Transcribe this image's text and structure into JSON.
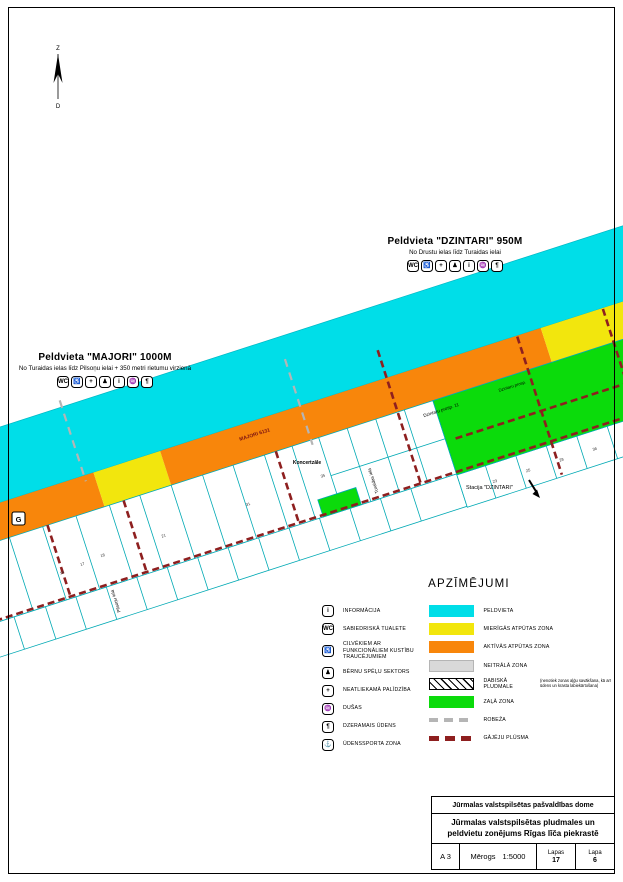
{
  "colors": {
    "beach": "#00dee8",
    "quiet_zone": "#f2e60d",
    "active_zone": "#f8860b",
    "neutral_zone": "#d9d9d9",
    "green_zone": "#0bdb0b",
    "parcel_outline": "#00a9b4",
    "pedestrian_flow": "#8e1f1f",
    "boundary": "#b5b5b5"
  },
  "compass": {
    "north": "Z",
    "south": "D"
  },
  "headers": {
    "dzintari": {
      "title": "Peldvieta \"DZINTARI\" 950M",
      "subtitle": "No Drustu ielas līdz Turaidas ielai"
    },
    "majori": {
      "title": "Peldvieta \"MAJORI\" 1000M",
      "subtitle": "No Turaidas ielas līdz Pilsoņu ielai + 350 metri rietumu virzienā"
    },
    "icons": [
      {
        "name": "wc",
        "glyph": "WC"
      },
      {
        "name": "wheelchair",
        "glyph": "♿"
      },
      {
        "name": "first-aid",
        "glyph": "+"
      },
      {
        "name": "playground",
        "glyph": "♟"
      },
      {
        "name": "info",
        "glyph": "i"
      },
      {
        "name": "shower",
        "glyph": "♒"
      },
      {
        "name": "drinking-water",
        "glyph": "¶"
      }
    ]
  },
  "map": {
    "cadastral": "MAJORI 6131",
    "koncertzale": "Koncertzāle",
    "dzintaru_prosp_11": "Dzintaru prosp. 11",
    "dzintaru_prosp": "Dzintaru prosp.",
    "station": "Stacija \"DZINTARI\"",
    "g_marker": "G",
    "street_turaidas": "Turaidas iela",
    "street_pilsonu": "Pilsoņu iela",
    "parcel_numbers": [
      "16",
      "17",
      "18",
      "21",
      "31",
      "35",
      "23",
      "25",
      "28",
      "36"
    ]
  },
  "legend": {
    "title": "APZĪMĒJUMI",
    "facilities": [
      {
        "glyph": "i",
        "label": "INFORMĀCIJA"
      },
      {
        "glyph": "WC",
        "label": "SABIEDRISKĀ TUALETE"
      },
      {
        "glyph": "♿",
        "label": "CILVĒKIEM AR FUNKCIONĀLIEM KUSTĪBU TRAUCĒJUMIEM"
      },
      {
        "glyph": "♟",
        "label": "BĒRNU SPĒĻU SEKTORS"
      },
      {
        "glyph": "+",
        "label": "NEATLIEKAMĀ PALĪDZĪBA"
      },
      {
        "glyph": "♒",
        "label": "DUŠAS"
      },
      {
        "glyph": "¶",
        "label": "DZERAMAIS ŪDENS"
      },
      {
        "glyph": "⚓",
        "label": "ŪDENSSPORTA ZONA"
      }
    ],
    "zones": [
      {
        "label": "PELDVIETA"
      },
      {
        "label": "MIERĪGĀS ATPŪTAS ZONA"
      },
      {
        "label": "AKTĪVĀS ATPŪTAS ZONA"
      },
      {
        "label": "NEITRĀLĀ ZONA"
      },
      {
        "label": "DABISKĀ PLUDMALE",
        "note": "(nenotiek zonas aļģu savākšana, kā arī ūdens un krasta labiekārtošana)"
      },
      {
        "label": "ZAĻĀ ZONA"
      },
      {
        "label": "ROBEŽA"
      },
      {
        "label": "GĀJĒJU PLŪSMA"
      }
    ]
  },
  "title_block": {
    "org": "Jūrmalas valstspilsētas pašvaldības dome",
    "title": "Jūrmalas valstspilsētas pludmales un peldvietu zonējums Rīgas līča piekrastē",
    "format": "A 3",
    "scale_label": "Mērogs",
    "scale_value": "1:5000",
    "pages_label": "Lapas",
    "pages_value": "17",
    "page_label": "Lapa",
    "page_value": "6"
  }
}
